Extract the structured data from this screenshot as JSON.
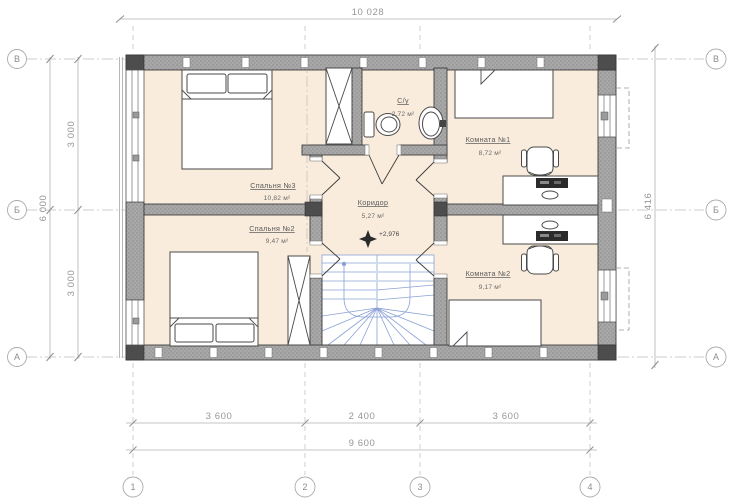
{
  "title": "Floor plan – attic level",
  "dims": {
    "top": "10 028",
    "left_total": "6 000",
    "left_a": "3 000",
    "left_b": "3 000",
    "right_total": "6 416",
    "bottom_a": "3 600",
    "bottom_b": "2 400",
    "bottom_c": "3 600",
    "bottom_total": "9 600"
  },
  "axes": {
    "rows": [
      "В",
      "Б",
      "А"
    ],
    "cols": [
      "1",
      "2",
      "3",
      "4"
    ]
  },
  "rooms": [
    {
      "name": "Спальня №3",
      "area": "10,82 м²"
    },
    {
      "name": "Спальня №2",
      "area": "9,47 м²"
    },
    {
      "name": "С/у",
      "area": "2,72 м²"
    },
    {
      "name": "Коридор",
      "area": "5,27 м²"
    },
    {
      "name": "Комната №1",
      "area": "8,72 м²"
    },
    {
      "name": "Комната №2",
      "area": "9,17 м²"
    }
  ],
  "elevation": {
    "value": "+2,976"
  },
  "colors": {
    "floor": "#f9ecdc",
    "wall": "#a6a6a6",
    "stair_blue": "#8ba1d6",
    "dim_gray": "#979797"
  }
}
